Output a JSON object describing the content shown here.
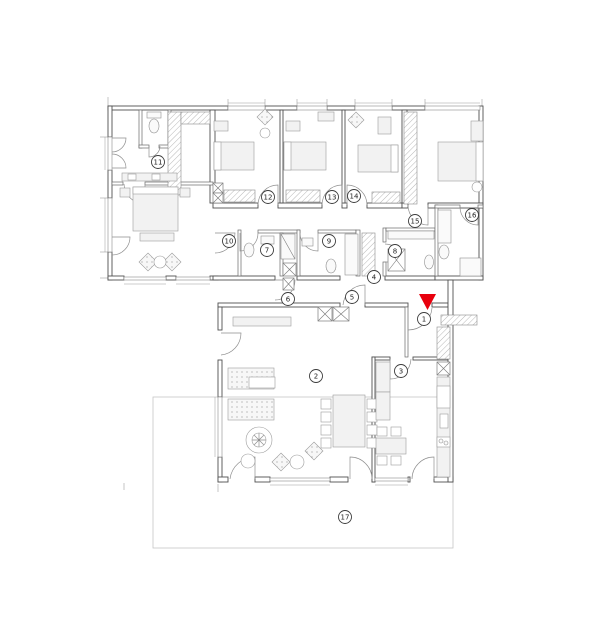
{
  "room_labels": [
    {
      "n": "1",
      "x": 424,
      "y": 319
    },
    {
      "n": "2",
      "x": 316,
      "y": 376
    },
    {
      "n": "3",
      "x": 401,
      "y": 371
    },
    {
      "n": "4",
      "x": 374,
      "y": 277
    },
    {
      "n": "5",
      "x": 352,
      "y": 297
    },
    {
      "n": "6",
      "x": 288,
      "y": 299
    },
    {
      "n": "7",
      "x": 267,
      "y": 250
    },
    {
      "n": "8",
      "x": 395,
      "y": 251
    },
    {
      "n": "9",
      "x": 329,
      "y": 241
    },
    {
      "n": "10",
      "x": 229,
      "y": 241
    },
    {
      "n": "11",
      "x": 158,
      "y": 162
    },
    {
      "n": "12",
      "x": 268,
      "y": 197
    },
    {
      "n": "13",
      "x": 332,
      "y": 197
    },
    {
      "n": "14",
      "x": 354,
      "y": 196
    },
    {
      "n": "15",
      "x": 415,
      "y": 221
    },
    {
      "n": "16",
      "x": 472,
      "y": 215
    },
    {
      "n": "17",
      "x": 345,
      "y": 517
    }
  ],
  "entrance_arrow": {
    "points": "419,294 436,294 427.5,310",
    "color": "#e8000d"
  },
  "colors": {
    "wall": "#4f4f4f",
    "furniture": "#9c9c9c",
    "terrace": "#c6c6c6",
    "label": "#3c3c3c"
  }
}
